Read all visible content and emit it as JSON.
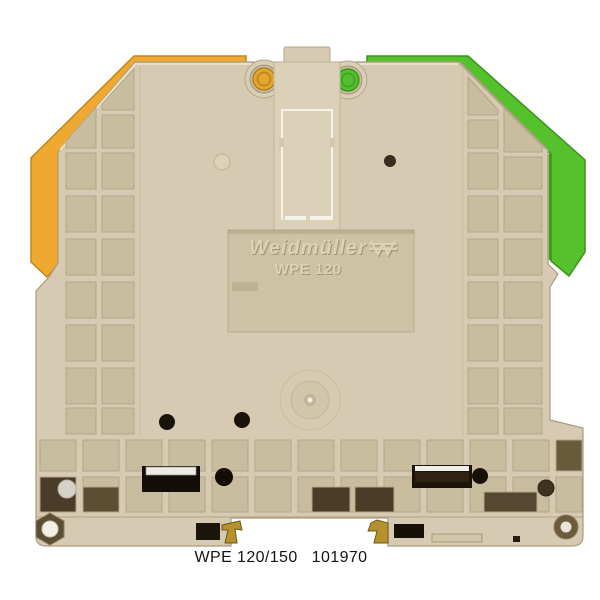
{
  "product": {
    "brand_marking": "Weidmüller",
    "model_marking": "WPE 120",
    "caption_model": "WPE 120/150",
    "caption_part_number": "101970"
  },
  "colors": {
    "background": "#ffffff",
    "body_beige": "#d6cbb2",
    "recess_beige": "#c9bd9f",
    "clamp_yellow": "#f0a930",
    "clamp_green": "#55c22d",
    "screw_yellow": "#e7a72e",
    "screw_green": "#52c02c",
    "brass": "#b6922f",
    "metal_silver": "#eceae4",
    "slot_black": "#130e07",
    "caption_text": "#141414"
  },
  "icons": {
    "logo": "weidmueller-logo-icon"
  }
}
